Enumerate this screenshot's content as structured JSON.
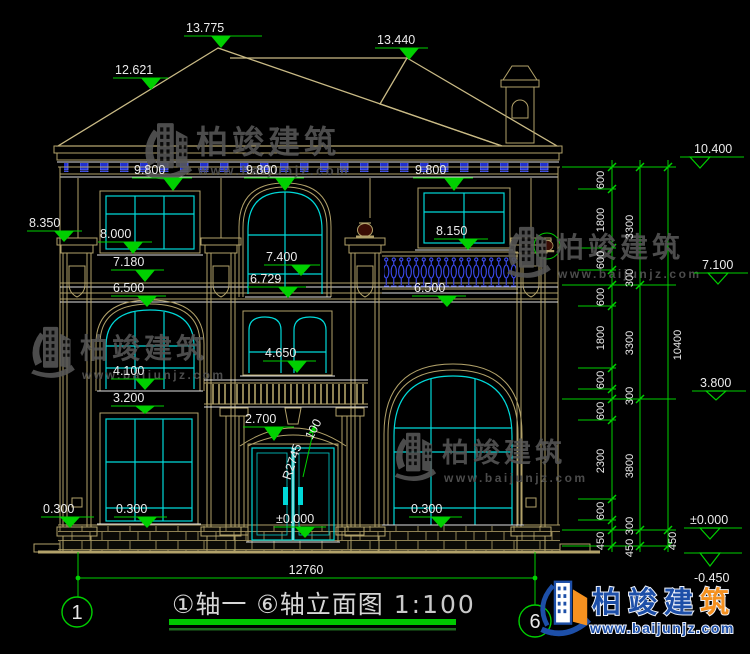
{
  "drawing": {
    "type": "house-front-elevation-cad",
    "title": {
      "text": "①轴一 ⑥轴立面图",
      "scale": "1:100"
    },
    "overall_width_dim": "12760"
  },
  "colors": {
    "background": "#000000",
    "dimension_green": "#00d000",
    "text_white": "#ececec",
    "wall_tan": "#b2a26a",
    "window_cyan": "#00d9d9",
    "baluster_blue": "#3d4cf5",
    "watermark_gray": "#575757",
    "logo_blue": "#1d4fa8",
    "logo_orange": "#f59120"
  },
  "watermark": {
    "brand": "柏竣建筑",
    "url": "www.baijunjz.com"
  },
  "watermarks": [
    {
      "ix": 136,
      "iy": 120,
      "s": 1.05,
      "tx": 196,
      "ty": 153,
      "fs": 32,
      "ux": 198,
      "uy": 175,
      "us": 13
    },
    {
      "ix": 500,
      "iy": 224,
      "s": 0.95,
      "tx": 556,
      "ty": 257,
      "fs": 28,
      "ux": 558,
      "uy": 278,
      "us": 12
    },
    {
      "ix": 24,
      "iy": 324,
      "s": 0.95,
      "tx": 80,
      "ty": 358,
      "fs": 28,
      "ux": 82,
      "uy": 379,
      "us": 12
    },
    {
      "ix": 388,
      "iy": 430,
      "s": 0.9,
      "tx": 442,
      "ty": 462,
      "fs": 27,
      "ux": 444,
      "uy": 482,
      "us": 12
    }
  ],
  "level_markers": [
    {
      "label": "13.775",
      "tx": 186,
      "ty": 32,
      "lx1": 184,
      "lx2": 262,
      "ly": 36,
      "ax": 221,
      "ay": 48
    },
    {
      "label": "12.621",
      "tx": 115,
      "ty": 74,
      "lx1": 113,
      "lx2": 168,
      "ly": 78,
      "ax": 151,
      "ay": 90
    },
    {
      "label": "13.440",
      "tx": 377,
      "ty": 44,
      "lx1": 375,
      "lx2": 428,
      "ly": 48,
      "ax": 409,
      "ay": 60
    },
    {
      "label": "9.800",
      "tx": 134,
      "ty": 174,
      "lx1": 132,
      "lx2": 192,
      "ly": 178,
      "ax": 173,
      "ay": 191
    },
    {
      "label": "9.800",
      "tx": 246,
      "ty": 174,
      "lx1": 244,
      "lx2": 304,
      "ly": 178,
      "ax": 285,
      "ay": 191
    },
    {
      "label": "9.800",
      "tx": 415,
      "ty": 174,
      "lx1": 413,
      "lx2": 473,
      "ly": 178,
      "ax": 454,
      "ay": 191
    },
    {
      "label": "8.350",
      "tx": 29,
      "ty": 227,
      "lx1": 27,
      "lx2": 82,
      "ly": 231,
      "ax": 64,
      "ay": 242
    },
    {
      "label": "8.000",
      "tx": 100,
      "ty": 238,
      "lx1": 98,
      "lx2": 152,
      "ly": 242,
      "ax": 133,
      "ay": 254
    },
    {
      "label": "7.180",
      "tx": 113,
      "ty": 266,
      "lx1": 111,
      "lx2": 164,
      "ly": 270,
      "ax": 145,
      "ay": 282
    },
    {
      "label": "6.500",
      "tx": 113,
      "ty": 292,
      "lx1": 111,
      "lx2": 166,
      "ly": 296,
      "ax": 147,
      "ay": 307
    },
    {
      "label": "7.400",
      "tx": 266,
      "ty": 261,
      "lx1": 264,
      "lx2": 320,
      "ly": 265,
      "ax": 301,
      "ay": 276
    },
    {
      "label": "6.729",
      "tx": 250,
      "ty": 283,
      "lx1": 248,
      "lx2": 306,
      "ly": 287,
      "ax": 288,
      "ay": 298
    },
    {
      "label": "8.150",
      "tx": 436,
      "ty": 235,
      "lx1": 434,
      "lx2": 488,
      "ly": 239,
      "ax": 468,
      "ay": 250
    },
    {
      "label": "6.500",
      "tx": 414,
      "ty": 292,
      "lx1": 412,
      "lx2": 466,
      "ly": 296,
      "ax": 447,
      "ay": 307
    },
    {
      "label": "4.650",
      "tx": 265,
      "ty": 357,
      "lx1": 263,
      "lx2": 316,
      "ly": 361,
      "ax": 297,
      "ay": 373
    },
    {
      "label": "4.100",
      "tx": 113,
      "ty": 375,
      "lx1": 111,
      "lx2": 164,
      "ly": 379,
      "ax": 145,
      "ay": 390
    },
    {
      "label": "3.200",
      "tx": 113,
      "ty": 402,
      "lx1": 111,
      "lx2": 164,
      "ly": 406,
      "ax": 145,
      "ay": 414
    },
    {
      "label": "2.700",
      "tx": 245,
      "ty": 423,
      "lx1": 243,
      "lx2": 294,
      "ly": 427,
      "ax": 274,
      "ay": 441
    },
    {
      "label": "0.300",
      "tx": 43,
      "ty": 513,
      "lx1": 41,
      "lx2": 94,
      "ly": 517,
      "ax": 70,
      "ay": 528
    },
    {
      "label": "0.300",
      "tx": 116,
      "ty": 513,
      "lx1": 114,
      "lx2": 167,
      "ly": 517,
      "ax": 147,
      "ay": 528
    },
    {
      "label": "0.300",
      "tx": 411,
      "ty": 513,
      "lx1": 409,
      "lx2": 462,
      "ly": 517,
      "ax": 441,
      "ay": 528
    },
    {
      "label": "±0.000",
      "tx": 276,
      "ty": 523,
      "lx1": 274,
      "lx2": 326,
      "ly": 527,
      "ax": 305,
      "ay": 538
    }
  ],
  "right_markers": [
    {
      "label": "10.400",
      "tx": 694,
      "ty": 153,
      "lx1": 680,
      "lx2": 744,
      "ly": 157,
      "ax": 700,
      "ay": 168,
      "open": true
    },
    {
      "label": "7.100",
      "tx": 702,
      "ty": 269,
      "lx1": 694,
      "lx2": 748,
      "ly": 273,
      "ax": 718,
      "ay": 284,
      "open": true
    },
    {
      "label": "3.800",
      "tx": 700,
      "ty": 387,
      "lx1": 692,
      "lx2": 746,
      "ly": 391,
      "ax": 716,
      "ay": 400,
      "open": true
    },
    {
      "label": "±0.000",
      "tx": 690,
      "ty": 524,
      "lx1": 684,
      "lx2": 742,
      "ly": 528,
      "ax": 710,
      "ay": 539,
      "open": true
    },
    {
      "label": "-0.450",
      "tx": 694,
      "ty": 582,
      "lx1": 684,
      "lx2": 742,
      "ly": 553,
      "ax": 710,
      "ay": 566,
      "open": true
    }
  ],
  "chain_labels": [
    {
      "label": "600",
      "x": 604,
      "y": 180
    },
    {
      "label": "1800",
      "x": 604,
      "y": 220
    },
    {
      "label": "600",
      "x": 604,
      "y": 260
    },
    {
      "label": "300",
      "x": 633,
      "y": 278
    },
    {
      "label": "600",
      "x": 604,
      "y": 297
    },
    {
      "label": "1800",
      "x": 604,
      "y": 338
    },
    {
      "label": "600",
      "x": 604,
      "y": 380
    },
    {
      "label": "300",
      "x": 633,
      "y": 396
    },
    {
      "label": "600",
      "x": 604,
      "y": 411
    },
    {
      "label": "2300",
      "x": 604,
      "y": 461
    },
    {
      "label": "600",
      "x": 604,
      "y": 511
    },
    {
      "label": "300",
      "x": 633,
      "y": 526
    },
    {
      "label": "450",
      "x": 604,
      "y": 541
    },
    {
      "label": "450",
      "x": 633,
      "y": 548
    },
    {
      "label": "3300",
      "x": 633,
      "y": 227
    },
    {
      "label": "3300",
      "x": 633,
      "y": 343
    },
    {
      "label": "3800",
      "x": 633,
      "y": 466
    },
    {
      "label": "450",
      "x": 676,
      "y": 541
    },
    {
      "label": "10400",
      "x": 681,
      "y": 345
    }
  ],
  "plain_labels": [
    {
      "label": "12760",
      "x": 306,
      "y": 574,
      "anchor": "middle",
      "rot": 0
    },
    {
      "label": "R2745",
      "x": 296,
      "y": 463,
      "anchor": "middle",
      "rot": -72
    },
    {
      "label": "100",
      "x": 317,
      "y": 431,
      "anchor": "middle",
      "rot": -62
    }
  ],
  "axis_bubbles": [
    {
      "label": "1",
      "cx": 77,
      "cy": 612,
      "r": 15
    },
    {
      "label": "6",
      "cx": 535,
      "cy": 621,
      "r": 16
    }
  ],
  "logo": {
    "brand_main": "柏竣建",
    "brand_last": "筑",
    "url": "www.baijunjz.com"
  }
}
